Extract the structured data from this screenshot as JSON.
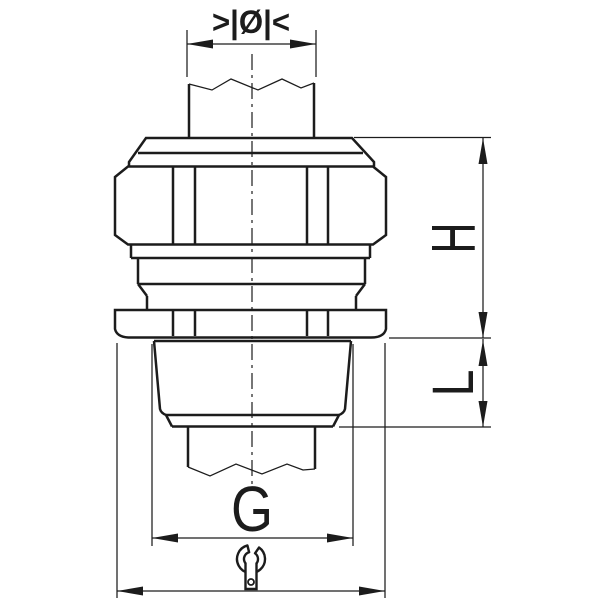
{
  "drawing": {
    "background": "#ffffff",
    "line_color": "#1c1c1c"
  },
  "labels": {
    "cable_diameter_symbol": ">|Ø|<",
    "height_dim": "H",
    "thread_length_dim": "L",
    "thread_size_dim": "G"
  },
  "icons": {
    "wrench": "open-end-wrench-icon"
  }
}
